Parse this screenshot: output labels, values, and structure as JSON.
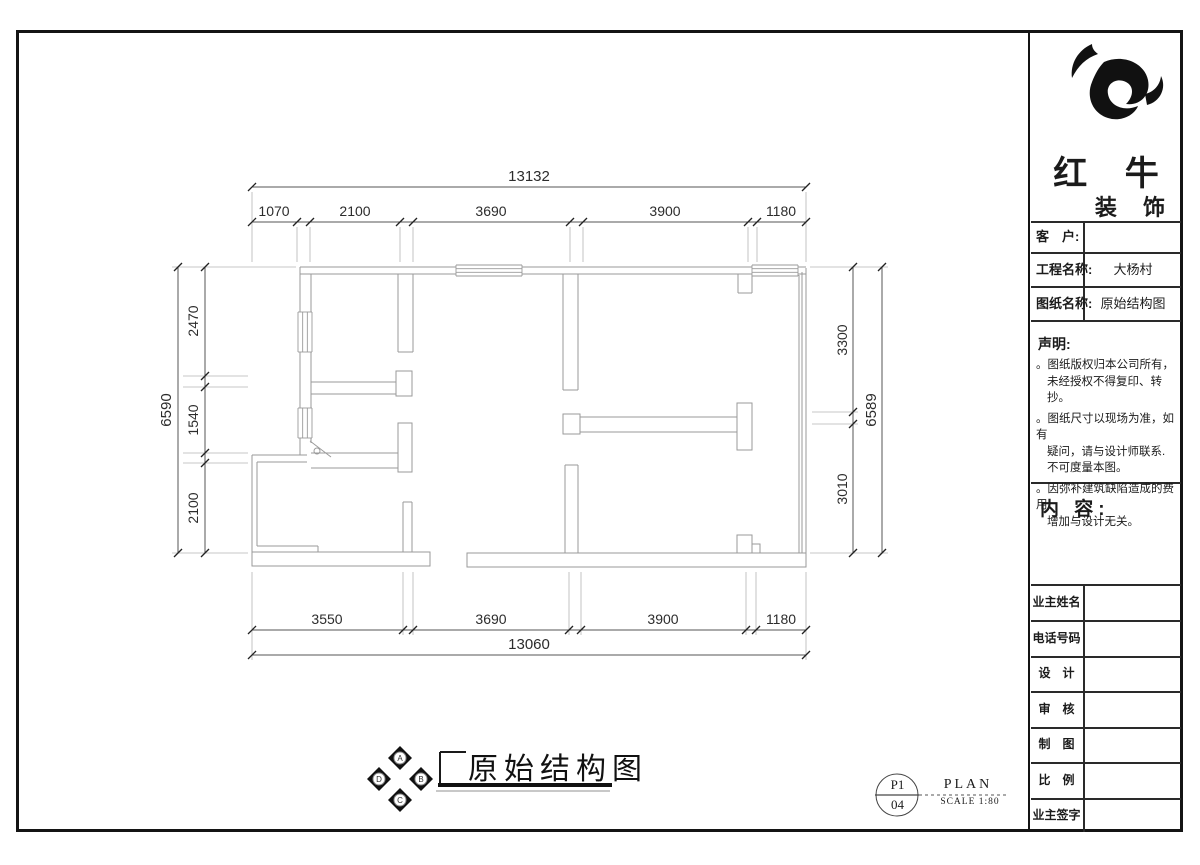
{
  "brand": {
    "line1": "红 牛",
    "line2": "装 饰"
  },
  "fields": {
    "client_label": "客　户:",
    "client_value": "",
    "project_label": "工程名称:",
    "project_value": "大杨村",
    "sheet_label": "图纸名称:",
    "sheet_value": "原始结构图"
  },
  "statement": {
    "title": "声明:",
    "lines": [
      {
        "text": "。图纸版权归本公司所有，"
      },
      {
        "text": "未经授权不得复印、转抄。"
      },
      {
        "text": "。图纸尺寸以现场为准，如有"
      },
      {
        "text": "疑问，请与设计师联系."
      },
      {
        "text": "不可度量本图。"
      },
      {
        "text": "。因弥补建筑缺陷造成的费用"
      },
      {
        "text": "增加与设计无关。"
      }
    ]
  },
  "content_label": "内 容:",
  "info_rows": [
    "业主姓名",
    "电话号码",
    "设　计",
    "审　核",
    "制　图",
    "比　例",
    "业主签字"
  ],
  "footer": {
    "drawing_title": "原始结构图",
    "sheet_top": "P1",
    "sheet_bottom": "04",
    "plan_label": "PLAN",
    "scale_label": "SCALE 1:80",
    "compass": {
      "top": "A",
      "right": "B",
      "bottom": "C",
      "left": "D"
    }
  },
  "dimensions": {
    "top": {
      "total": "13132",
      "segments": [
        "1070",
        "2100",
        "3690",
        "3900",
        "1180"
      ]
    },
    "bottom": {
      "total": "13060",
      "segments": [
        "3550",
        "3690",
        "3900",
        "1180"
      ]
    },
    "left": {
      "total": "6590",
      "segments": [
        "2470",
        "1540",
        "2100"
      ]
    },
    "right": {
      "total": "6589",
      "segments": [
        "3300",
        "3010"
      ]
    }
  },
  "geometry": {
    "plan": {
      "wall_lines": [
        [
          300,
          267,
          806,
          267
        ],
        [
          300,
          274,
          806,
          274
        ],
        [
          300,
          267,
          300,
          455
        ],
        [
          311,
          274,
          311,
          443
        ],
        [
          252,
          455,
          307,
          455
        ],
        [
          257,
          462,
          307,
          462
        ],
        [
          252,
          455,
          252,
          552
        ],
        [
          257,
          462,
          257,
          546
        ],
        [
          257,
          546,
          318,
          546
        ],
        [
          318,
          546,
          318,
          552
        ],
        [
          806,
          268,
          806,
          567
        ],
        [
          802,
          272,
          802,
          556
        ],
        [
          799,
          275,
          799,
          553
        ],
        [
          398,
          274,
          398,
          352
        ],
        [
          413,
          274,
          413,
          352
        ],
        [
          398,
          352,
          413,
          352
        ],
        [
          563,
          274,
          563,
          390
        ],
        [
          578,
          274,
          578,
          390
        ],
        [
          563,
          390,
          578,
          390
        ],
        [
          738,
          274,
          738,
          293
        ],
        [
          752,
          274,
          752,
          293
        ],
        [
          738,
          293,
          752,
          293
        ],
        [
          311,
          382,
          396,
          382
        ],
        [
          311,
          394,
          396,
          394
        ],
        [
          311,
          453,
          398,
          453
        ],
        [
          311,
          468,
          398,
          468
        ],
        [
          580,
          417,
          737,
          417
        ],
        [
          580,
          432,
          737,
          432
        ],
        [
          403,
          502,
          403,
          552
        ],
        [
          412,
          502,
          412,
          552
        ],
        [
          403,
          502,
          412,
          502
        ],
        [
          565,
          465,
          565,
          553
        ],
        [
          578,
          465,
          578,
          553
        ],
        [
          565,
          465,
          578,
          465
        ]
      ],
      "wall_rects": [
        [
          396,
          371,
          16,
          25
        ],
        [
          398,
          423,
          14,
          49
        ],
        [
          563,
          414,
          17,
          20
        ],
        [
          737,
          403,
          15,
          47
        ],
        [
          252,
          552,
          178,
          14
        ],
        [
          467,
          553,
          339,
          14
        ],
        [
          737,
          535,
          15,
          18
        ],
        [
          752,
          544,
          8,
          9
        ]
      ],
      "windows": [
        {
          "o": "h",
          "x1": 456,
          "x2": 522,
          "y1": 265,
          "y2": 276
        },
        {
          "o": "h",
          "x1": 752,
          "x2": 798,
          "y1": 265,
          "y2": 276
        },
        {
          "o": "v",
          "x1": 298,
          "x2": 312,
          "y1": 312,
          "y2": 352
        },
        {
          "o": "v",
          "x1": 298,
          "x2": 312,
          "y1": 408,
          "y2": 438
        }
      ],
      "door": {
        "line": [
          310,
          441,
          331,
          457
        ],
        "circle": [
          317,
          451,
          3
        ]
      }
    },
    "dims": {
      "top": {
        "total_line": [
          252,
          187,
          806,
          187
        ],
        "chain_line": [
          252,
          222,
          806,
          222
        ],
        "total_ticks": [
          [
            252,
            187
          ],
          [
            806,
            187
          ]
        ],
        "chain_ticks": [
          [
            252,
            222
          ],
          [
            297,
            222
          ],
          [
            310,
            222
          ],
          [
            400,
            222
          ],
          [
            413,
            222
          ],
          [
            570,
            222
          ],
          [
            583,
            222
          ],
          [
            748,
            222
          ],
          [
            757,
            222
          ],
          [
            806,
            222
          ]
        ],
        "total_label": {
          "x": 529,
          "y": 181,
          "rot": 0
        },
        "seg_labels": [
          {
            "x": 274,
            "y": 216,
            "rot": 0
          },
          {
            "x": 355,
            "y": 216,
            "rot": 0
          },
          {
            "x": 491,
            "y": 216,
            "rot": 0
          },
          {
            "x": 665,
            "y": 216,
            "rot": 0
          },
          {
            "x": 781,
            "y": 216,
            "rot": 0
          }
        ],
        "ext": [
          [
            252,
            192,
            252,
            262
          ],
          [
            297,
            227,
            297,
            262
          ],
          [
            310,
            227,
            310,
            262
          ],
          [
            400,
            227,
            400,
            262
          ],
          [
            413,
            227,
            413,
            262
          ],
          [
            570,
            227,
            570,
            262
          ],
          [
            583,
            227,
            583,
            262
          ],
          [
            748,
            227,
            748,
            262
          ],
          [
            757,
            227,
            757,
            262
          ],
          [
            806,
            192,
            806,
            262
          ]
        ]
      },
      "bottom": {
        "total_line": [
          252,
          655,
          806,
          655
        ],
        "chain_line": [
          252,
          630,
          806,
          630
        ],
        "total_ticks": [
          [
            252,
            655
          ],
          [
            806,
            655
          ]
        ],
        "chain_ticks": [
          [
            252,
            630
          ],
          [
            403,
            630
          ],
          [
            413,
            630
          ],
          [
            569,
            630
          ],
          [
            581,
            630
          ],
          [
            746,
            630
          ],
          [
            756,
            630
          ],
          [
            806,
            630
          ]
        ],
        "total_label": {
          "x": 529,
          "y": 649,
          "rot": 0
        },
        "seg_labels": [
          {
            "x": 327,
            "y": 624,
            "rot": 0
          },
          {
            "x": 491,
            "y": 624,
            "rot": 0
          },
          {
            "x": 663,
            "y": 624,
            "rot": 0
          },
          {
            "x": 781,
            "y": 624,
            "rot": 0
          }
        ],
        "ext": [
          [
            252,
            572,
            252,
            660
          ],
          [
            403,
            572,
            403,
            635
          ],
          [
            413,
            572,
            413,
            635
          ],
          [
            569,
            572,
            569,
            635
          ],
          [
            581,
            572,
            581,
            635
          ],
          [
            746,
            572,
            746,
            635
          ],
          [
            756,
            572,
            756,
            635
          ],
          [
            806,
            572,
            806,
            660
          ]
        ]
      },
      "left": {
        "total_line": [
          178,
          267,
          178,
          553
        ],
        "chain_line": [
          205,
          267,
          205,
          553
        ],
        "total_ticks": [
          [
            178,
            267
          ],
          [
            178,
            553
          ]
        ],
        "chain_ticks": [
          [
            205,
            267
          ],
          [
            205,
            376
          ],
          [
            205,
            387
          ],
          [
            205,
            453
          ],
          [
            205,
            463
          ],
          [
            205,
            553
          ]
        ],
        "total_label": {
          "x": 171,
          "y": 410,
          "rot": -90
        },
        "seg_labels": [
          {
            "x": 198,
            "y": 321,
            "rot": -90
          },
          {
            "x": 198,
            "y": 420,
            "rot": -90
          },
          {
            "x": 198,
            "y": 508,
            "rot": -90
          }
        ],
        "ext": [
          [
            172,
            267,
            296,
            267
          ],
          [
            183,
            376,
            248,
            376
          ],
          [
            183,
            387,
            248,
            387
          ],
          [
            183,
            453,
            248,
            453
          ],
          [
            183,
            463,
            248,
            463
          ],
          [
            172,
            553,
            248,
            553
          ]
        ]
      },
      "right": {
        "total_line": [
          882,
          267,
          882,
          553
        ],
        "chain_line": [
          853,
          267,
          853,
          553
        ],
        "total_ticks": [
          [
            882,
            267
          ],
          [
            882,
            553
          ]
        ],
        "chain_ticks": [
          [
            853,
            267
          ],
          [
            853,
            412
          ],
          [
            853,
            424
          ],
          [
            853,
            553
          ]
        ],
        "total_label": {
          "x": 876,
          "y": 410,
          "rot": -90
        },
        "seg_labels": [
          {
            "x": 847,
            "y": 340,
            "rot": -90
          },
          {
            "x": 847,
            "y": 489,
            "rot": -90
          }
        ],
        "ext": [
          [
            810,
            267,
            888,
            267
          ],
          [
            812,
            412,
            858,
            412
          ],
          [
            812,
            424,
            858,
            424
          ],
          [
            810,
            553,
            888,
            553
          ]
        ]
      }
    },
    "footer_deco": {
      "lines": [
        [
          440,
          752,
          466,
          752,
          2
        ],
        [
          440,
          752,
          440,
          785,
          2
        ],
        [
          875,
          795,
          919,
          795,
          1
        ]
      ],
      "dashed": [
        [
          919,
          795,
          1008,
          795
        ]
      ],
      "bars": [
        [
          438,
          783,
          174,
          4
        ]
      ],
      "gray_lines": [
        [
          436,
          791,
          610,
          791
        ]
      ],
      "circle": [
        897,
        795,
        21
      ]
    }
  }
}
